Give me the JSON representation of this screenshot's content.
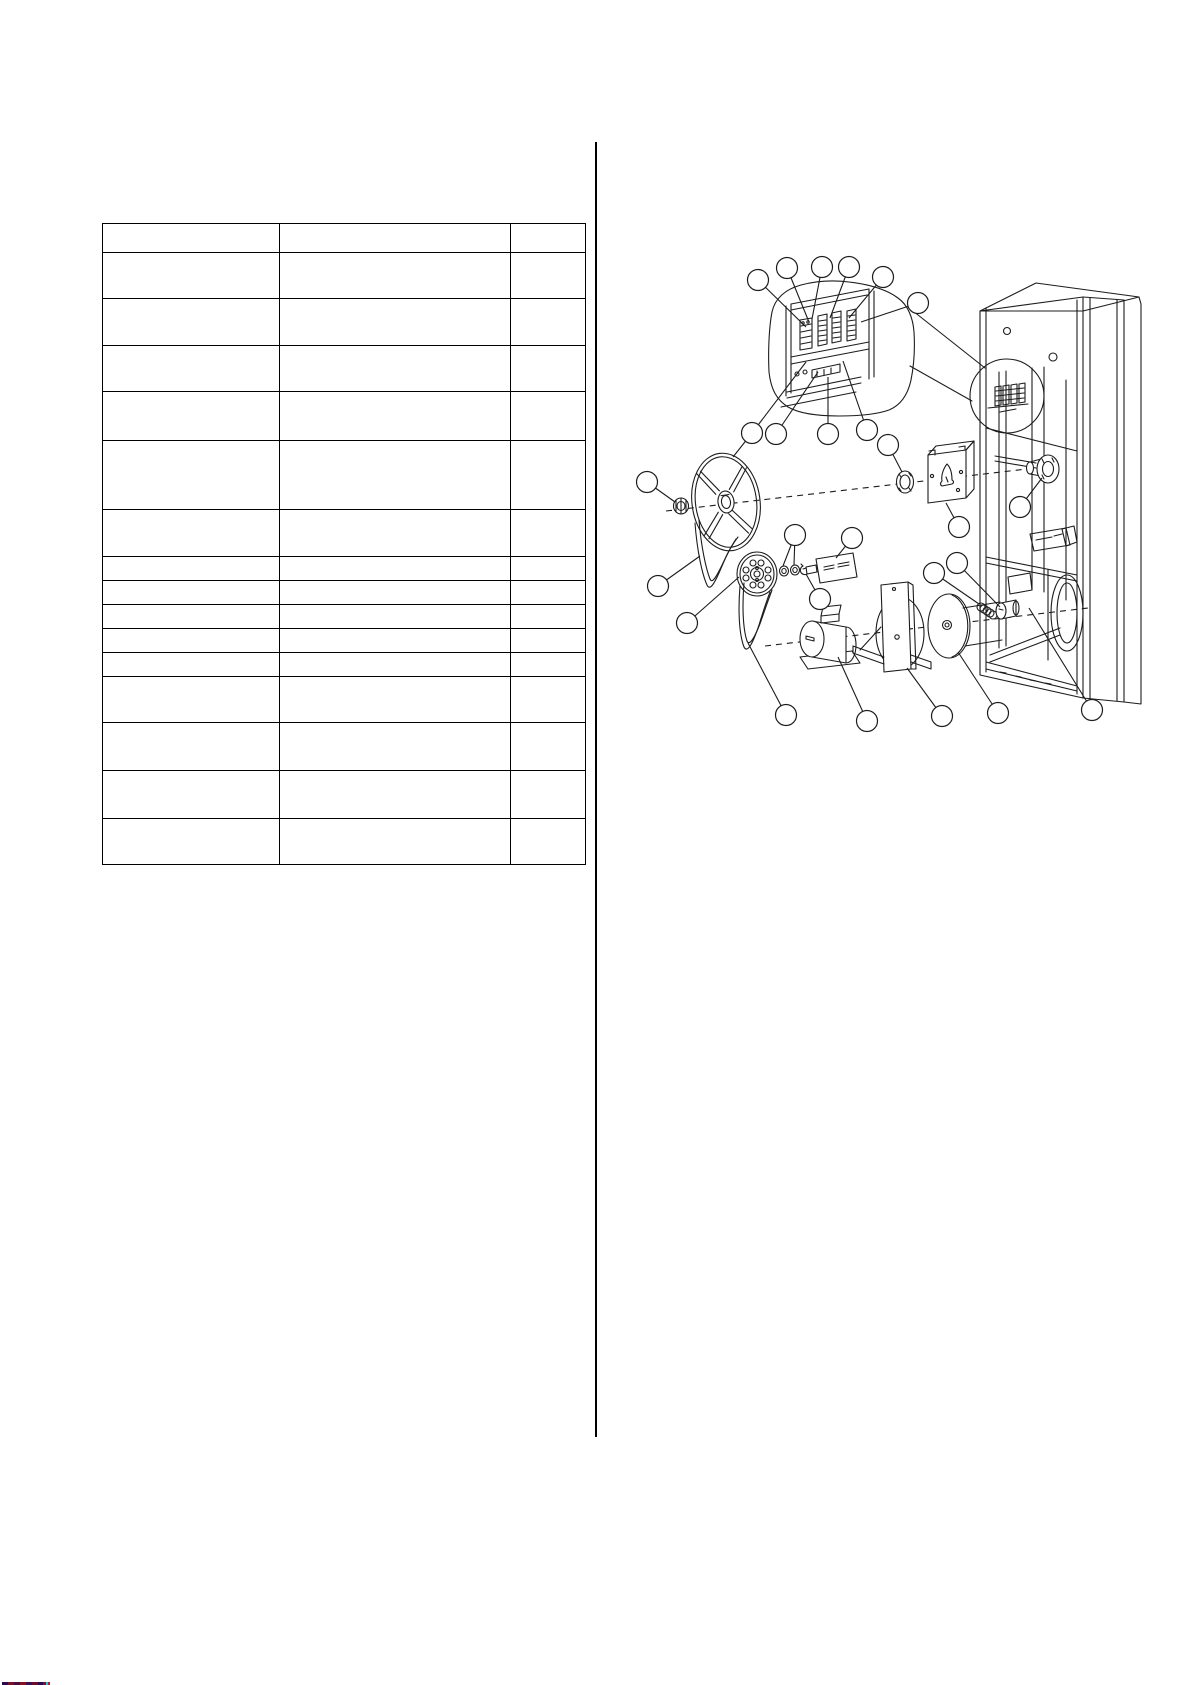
{
  "page": {
    "width": 1192,
    "height": 1685,
    "background": "#ffffff",
    "line_color": "#1c1c1c"
  },
  "column_divider": {
    "x": 595,
    "y1": 142,
    "y2": 1437
  },
  "parts_table": {
    "x": 102,
    "y": 223,
    "width": 483,
    "height": 641,
    "columns": 3,
    "column_widths": [
      177,
      231,
      75
    ],
    "row_heights": [
      29,
      46,
      47,
      46,
      49,
      69,
      47,
      24,
      24,
      24,
      24,
      24,
      46,
      48,
      48,
      46
    ],
    "cell_text": ""
  },
  "diagram": {
    "region": {
      "x": 596,
      "y": 230,
      "width": 596,
      "height": 520
    },
    "callout_radius": 10.5,
    "callouts": [
      {
        "cx": 758,
        "cy": 280,
        "leaders": [
          [
            806,
            327
          ]
        ]
      },
      {
        "cx": 787,
        "cy": 268,
        "leaders": [
          [
            809,
            322
          ]
        ]
      },
      {
        "cx": 822,
        "cy": 267,
        "leaders": [
          [
            812,
            319
          ]
        ]
      },
      {
        "cx": 849,
        "cy": 267,
        "leaders": [
          [
            830,
            318
          ]
        ]
      },
      {
        "cx": 883,
        "cy": 277,
        "leaders": [
          [
            849,
            318
          ]
        ]
      },
      {
        "cx": 918,
        "cy": 303,
        "leaders": [
          [
            861,
            322
          ]
        ]
      },
      {
        "cx": 752,
        "cy": 433,
        "leaders": [
          [
            806,
            362
          ],
          [
            733,
            457
          ]
        ]
      },
      {
        "cx": 776,
        "cy": 434,
        "leaders": [
          [
            818,
            372
          ]
        ]
      },
      {
        "cx": 828,
        "cy": 434,
        "leaders": [
          [
            828,
            377
          ]
        ]
      },
      {
        "cx": 867,
        "cy": 430,
        "leaders": [
          [
            843,
            361
          ]
        ]
      },
      {
        "cx": 647,
        "cy": 482,
        "leaders": [
          [
            675,
            502
          ]
        ]
      },
      {
        "cx": 658,
        "cy": 586,
        "leaders": [
          [
            700,
            556
          ]
        ]
      },
      {
        "cx": 687,
        "cy": 623,
        "leaders": [
          [
            739,
            577
          ]
        ]
      },
      {
        "cx": 795,
        "cy": 535,
        "leaders": [
          [
            783,
            566
          ],
          [
            794,
            565
          ]
        ]
      },
      {
        "cx": 820,
        "cy": 599,
        "leaders": [
          [
            806,
            574
          ]
        ]
      },
      {
        "cx": 852,
        "cy": 538,
        "leaders": [
          [
            836,
            558
          ]
        ]
      },
      {
        "cx": 888,
        "cy": 445,
        "leaders": [
          [
            902,
            472
          ]
        ]
      },
      {
        "cx": 959,
        "cy": 527,
        "leaders": [
          [
            946,
            503
          ]
        ]
      },
      {
        "cx": 934,
        "cy": 573,
        "leaders": [
          [
            979,
            604
          ]
        ]
      },
      {
        "cx": 957,
        "cy": 563,
        "leaders": [
          [
            1000,
            607
          ]
        ]
      },
      {
        "cx": 1020,
        "cy": 507,
        "leaders": [
          [
            1042,
            478
          ]
        ]
      },
      {
        "cx": 786,
        "cy": 715,
        "leaders": [
          [
            748,
            643
          ]
        ]
      },
      {
        "cx": 867,
        "cy": 721,
        "leaders": [
          [
            838,
            657
          ]
        ]
      },
      {
        "cx": 942,
        "cy": 716,
        "leaders": [
          [
            907,
            668
          ]
        ]
      },
      {
        "cx": 998,
        "cy": 713,
        "leaders": [
          [
            958,
            652
          ]
        ]
      },
      {
        "cx": 1092,
        "cy": 710,
        "leaders": [
          [
            1029,
            608
          ]
        ]
      }
    ],
    "dashed_axes": [
      [
        666,
        511,
        1044,
        467
      ],
      [
        765,
        646,
        1088,
        608
      ]
    ]
  },
  "footer_fragment": {
    "x": 2,
    "y": 1682,
    "height": 3,
    "segments": [
      {
        "w": 6,
        "color": "#2d0a4e"
      },
      {
        "w": 6,
        "color": "#7a1030"
      },
      {
        "w": 6,
        "color": "#4a0c3a"
      },
      {
        "w": 6,
        "color": "#8b1020"
      },
      {
        "w": 6,
        "color": "#3a1050"
      },
      {
        "w": 6,
        "color": "#6b0d28"
      },
      {
        "w": 5,
        "color": "#2d0a4e"
      },
      {
        "w": 5,
        "color": "#801525"
      }
    ],
    "dots": [
      {
        "x": 46,
        "y": 1682,
        "color": "#20c8d4"
      },
      {
        "x": 48,
        "y": 1682,
        "color": "#c0182c"
      }
    ]
  }
}
